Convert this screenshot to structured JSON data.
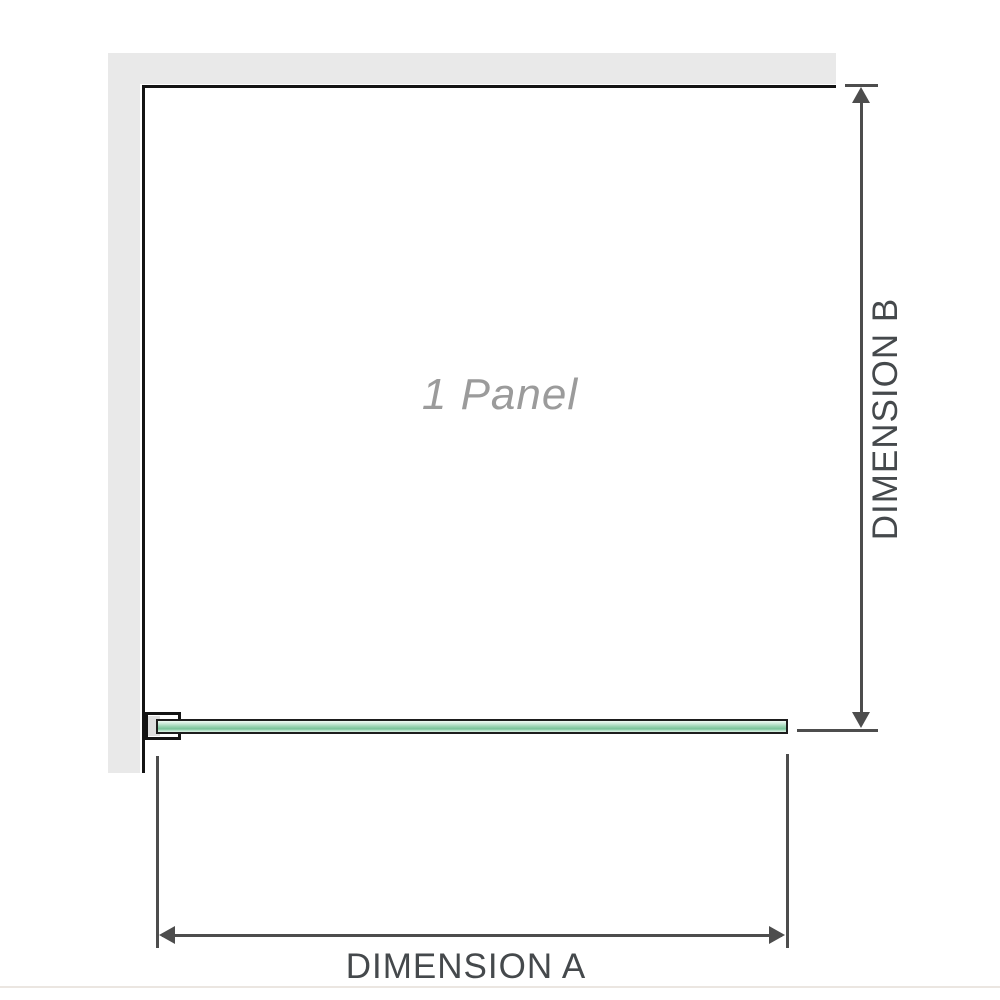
{
  "diagram": {
    "panel_label": "1 Panel",
    "dimensions": {
      "a_label": "DIMENSION A",
      "b_label": "DIMENSION B"
    },
    "colors": {
      "wall_gray": "#e9e9e9",
      "panel_outline": "#141414",
      "dimension_line": "#4d4d4d",
      "dimension_text": "#45494c",
      "panel_label_text": "#9b9b9b",
      "glass_green_mid": "#98d2b1",
      "glass_green_dark": "#78c299",
      "bottom_divider": "#ebe6e1"
    }
  }
}
